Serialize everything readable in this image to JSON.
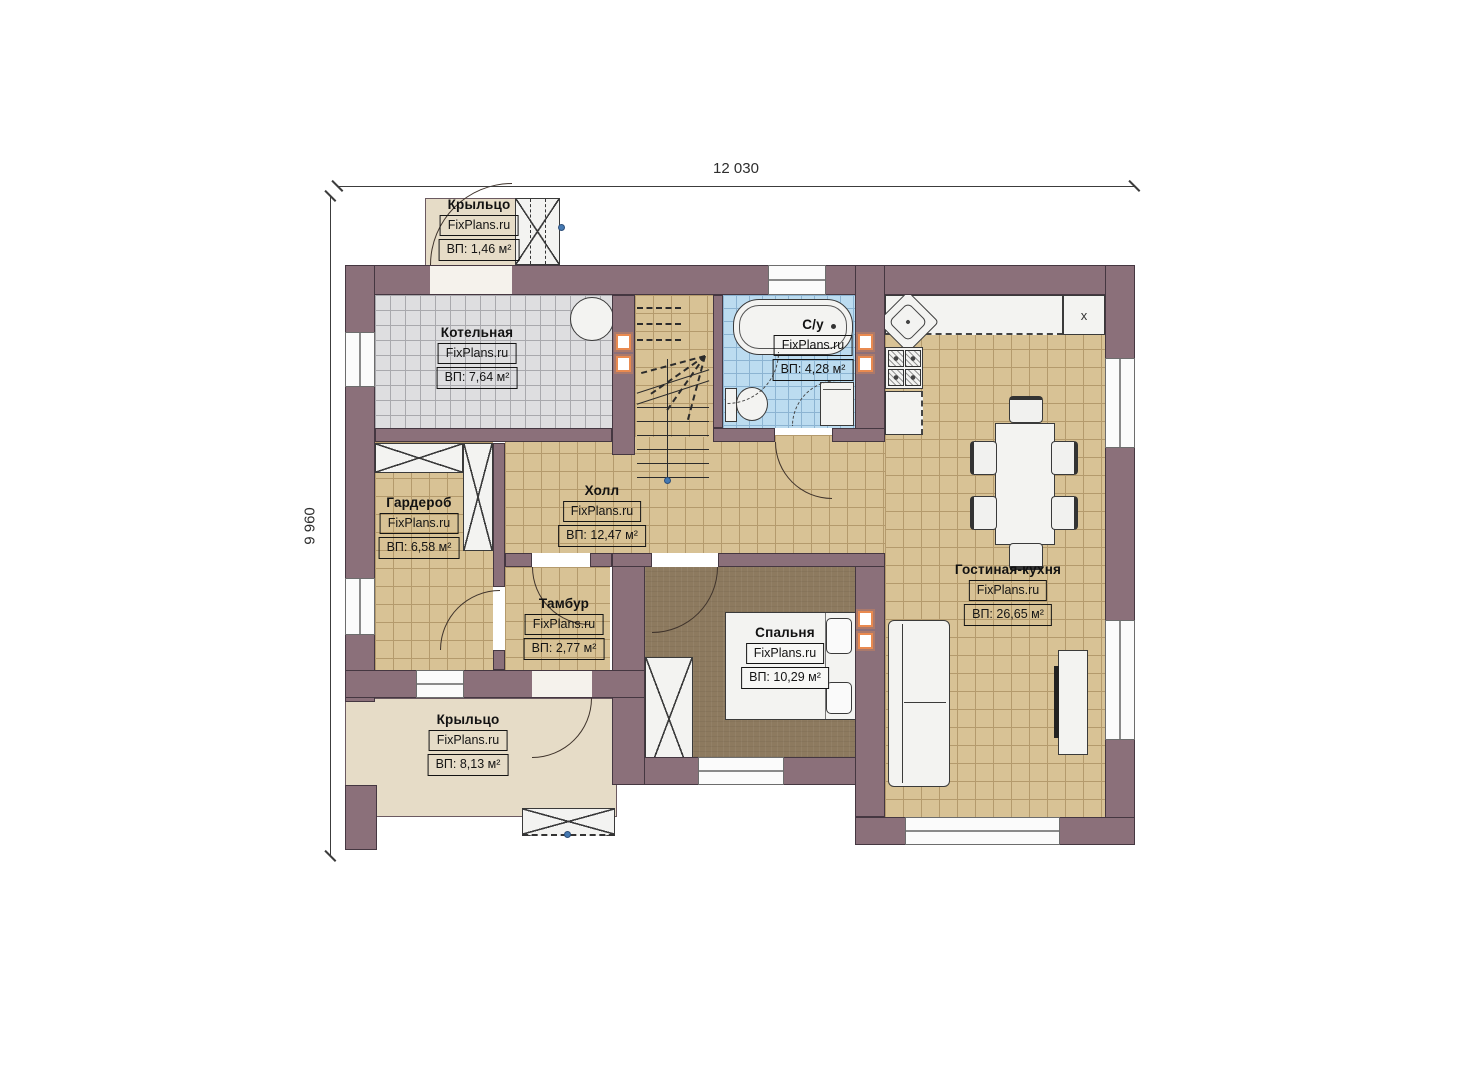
{
  "dimensions": {
    "width_label": "12 030",
    "height_label": "9 960"
  },
  "rooms": {
    "porch_top": {
      "name": "Крыльцо",
      "brand": "FixPlans.ru",
      "area": "ВП: 1,46 м²"
    },
    "boiler": {
      "name": "Котельная",
      "brand": "FixPlans.ru",
      "area": "ВП: 7,64 м²"
    },
    "bathroom": {
      "name": "С/у",
      "brand": "FixPlans.ru",
      "area": "ВП: 4,28 м²"
    },
    "wardrobe": {
      "name": "Гардероб",
      "brand": "FixPlans.ru",
      "area": "ВП: 6,58 м²"
    },
    "hall": {
      "name": "Холл",
      "brand": "FixPlans.ru",
      "area": "ВП: 12,47 м²"
    },
    "tambur": {
      "name": "Тамбур",
      "brand": "FixPlans.ru",
      "area": "ВП: 2,77 м²"
    },
    "bedroom": {
      "name": "Спальня",
      "brand": "FixPlans.ru",
      "area": "ВП: 10,29 м²"
    },
    "living": {
      "name": "Гостиная-кухня",
      "brand": "FixPlans.ru",
      "area": "ВП: 26,65 м²"
    },
    "porch_bottom": {
      "name": "Крыльцо",
      "brand": "FixPlans.ru",
      "area": "ВП: 8,13 м²"
    }
  },
  "kitchen": {
    "appliance_marker": "x"
  },
  "colors": {
    "wall": "#8b707a",
    "floor_tan": "#d8c295",
    "floor_gray": "#dedee0",
    "floor_blue": "#bcdcf0",
    "floor_bedroom": "#8d7a5f",
    "floor_porch": "#e6dcc7",
    "accent_orange": "#e98a50",
    "marker_blue": "#4579b2"
  }
}
